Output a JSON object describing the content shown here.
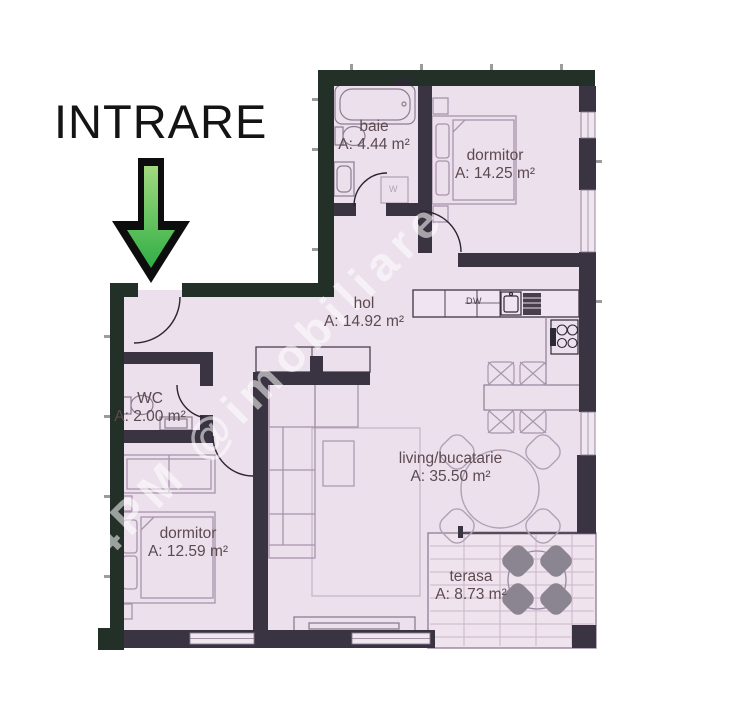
{
  "entrance": {
    "label": "INTRARE"
  },
  "watermark": {
    "text": "4PM @imobiliare"
  },
  "rooms": {
    "baie": {
      "name": "baie",
      "area": "A: 4.44 m²"
    },
    "dormitor1": {
      "name": "dormitor",
      "area": "A: 14.25 m²"
    },
    "hol": {
      "name": "hol",
      "area": "A: 14.92 m²"
    },
    "wc": {
      "name": "WC",
      "area": "A: 2.00 m²"
    },
    "dormitor2": {
      "name": "dormitor",
      "area": "A: 12.59 m²"
    },
    "living": {
      "name": "living/bucatarie",
      "area": "A: 35.50 m²"
    },
    "terasa": {
      "name": "terasa",
      "area": "A: 8.73 m²"
    }
  },
  "appliances": {
    "dishwasher": "DW",
    "washer": "W"
  },
  "colors": {
    "floor": "#ece0ec",
    "wall_exterior": "#233028",
    "wall_interior": "#3a3342",
    "window": "#f0e6f0",
    "furniture_outline": "#a995ad",
    "terrace_chair": "#8b8591",
    "arrow_green": "#3fbf4e",
    "label_text": "#5d4a50",
    "watermark_white": "#ffffff"
  }
}
